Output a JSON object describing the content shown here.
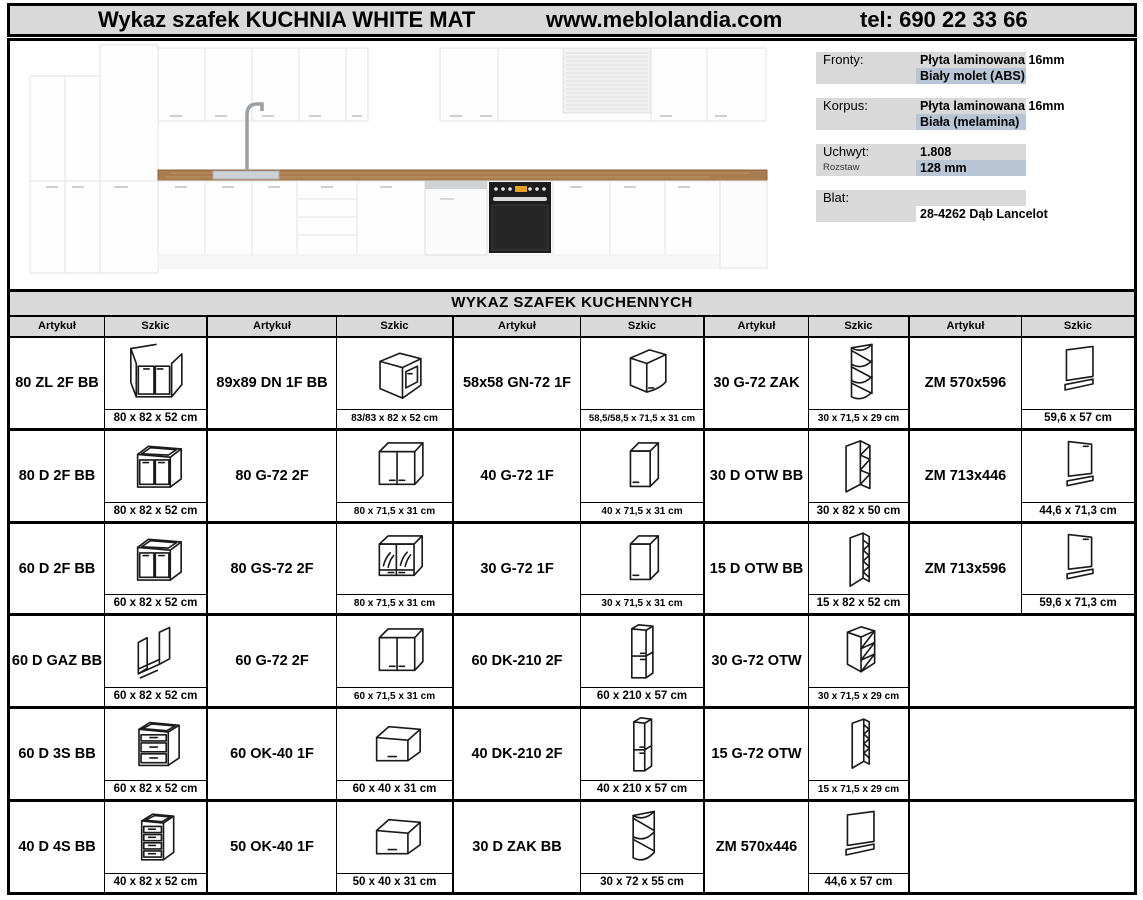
{
  "header": {
    "title": "Wykaz szafek KUCHNIA WHITE MAT",
    "website": "www.meblolandia.com",
    "phone": "tel: 690 22 33 66"
  },
  "colors": {
    "band_gray": "#d9d9d9",
    "highlight_blue": "#b7c5d5",
    "border_black": "#000000",
    "countertop_wood": "#a87c4f",
    "oven_black": "#1c1c1c"
  },
  "kitchen_render": {
    "icon": "kitchen-visualization-image"
  },
  "spec_panel": {
    "rows": [
      {
        "label": "Fronty:",
        "value1": "Płyta laminowana 16mm",
        "value2": "Biały molet (ABS)",
        "value2_highlight": true
      },
      {
        "label": "Korpus:",
        "value1": "Płyta laminowana 16mm",
        "value2": "Biała (melamina)",
        "value2_highlight": true
      },
      {
        "label": "Uchwyt:",
        "sublabel": "Rozstaw",
        "value1": "1.808",
        "value2": "128 mm",
        "value2_highlight": true
      },
      {
        "label": "Blat:",
        "value1": "",
        "value2": "28-4262 Dąb Lancelot",
        "value2_highlight": false
      }
    ]
  },
  "table": {
    "title": "WYKAZ SZAFEK KUCHENNYCH",
    "col_headers": [
      "Artykuł",
      "Szkic"
    ],
    "rows": [
      [
        {
          "code": "80 ZL 2F BB",
          "dims": "80 x 82 x 52 cm",
          "sketch": "sink-base-2door"
        },
        {
          "code": "89x89 DN 1F BB",
          "dims": "83/83 x 82 x 52 cm",
          "sketch": "corner-base-1door"
        },
        {
          "code": "58x58 GN-72 1F",
          "dims": "58,5/58,5 x 71,5 x 31 cm",
          "sketch": "corner-wall-1door"
        },
        {
          "code": "30 G-72 ZAK",
          "dims": "30 x 71,5 x 29 cm",
          "sketch": "corner-open-shelf-3"
        },
        {
          "code": "ZM 570x596",
          "dims": "59,6 x 57 cm",
          "sketch": "cover-panel"
        }
      ],
      [
        {
          "code": "80 D 2F BB",
          "dims": "80 x 82 x 52 cm",
          "sketch": "base-2door"
        },
        {
          "code": "80 G-72 2F",
          "dims": "80 x 71,5 x 31 cm",
          "sketch": "wall-2door"
        },
        {
          "code": "40 G-72 1F",
          "dims": "40 x 71,5 x 31 cm",
          "sketch": "wall-1door"
        },
        {
          "code": "30 D OTW BB",
          "dims": "30 x 82 x 50 cm",
          "sketch": "base-open-shelf-3"
        },
        {
          "code": "ZM 713x446",
          "dims": "44,6 x 71,3 cm",
          "sketch": "appliance-front-panel"
        }
      ],
      [
        {
          "code": "60 D 2F BB",
          "dims": "60 x 82 x 52 cm",
          "sketch": "base-2door"
        },
        {
          "code": "80 GS-72 2F",
          "dims": "80 x 71,5 x 31 cm",
          "sketch": "wall-glass-2door"
        },
        {
          "code": "30 G-72 1F",
          "dims": "30 x 71,5 x 31 cm",
          "sketch": "wall-1door"
        },
        {
          "code": "15 D OTW BB",
          "dims": "15 x 82 x 52 cm",
          "sketch": "cargo-base-15"
        },
        {
          "code": "ZM 713x596",
          "dims": "59,6 x 71,3 cm",
          "sketch": "appliance-front-panel"
        }
      ],
      [
        {
          "code": "60 D GAZ BB",
          "dims": "60 x 82 x 52 cm",
          "sketch": "oven-housing"
        },
        {
          "code": "60 G-72 2F",
          "dims": "60 x 71,5 x 31 cm",
          "sketch": "wall-2door"
        },
        {
          "code": "60 DK-210 2F",
          "dims": "60 x 210 x 57 cm",
          "sketch": "tall-2door"
        },
        {
          "code": "30 G-72 OTW",
          "dims": "30 x 71,5 x 29 cm",
          "sketch": "wall-open-shelf-3"
        },
        null
      ],
      [
        {
          "code": "60 D 3S BB",
          "dims": "60 x 82 x 52 cm",
          "sketch": "drawer-base-3"
        },
        {
          "code": "60 OK-40 1F",
          "dims": "60 x 40 x 31 cm",
          "sketch": "flipup-wall-1door"
        },
        {
          "code": "40 DK-210 2F",
          "dims": "40 x 210 x 57 cm",
          "sketch": "tall-2door-narrow"
        },
        {
          "code": "15 G-72 OTW",
          "dims": "15 x 71,5 x 29 cm",
          "sketch": "cargo-wall-15"
        },
        null
      ],
      [
        {
          "code": "40 D 4S BB",
          "dims": "40 x 82 x 52 cm",
          "sketch": "drawer-base-4"
        },
        {
          "code": "50 OK-40 1F",
          "dims": "50 x 40 x 31 cm",
          "sketch": "flipup-wall-1door"
        },
        {
          "code": "30 D ZAK BB",
          "dims": "30 x 72 x 55 cm",
          "sketch": "corner-open-shelf-2"
        },
        {
          "code": "ZM 570x446",
          "dims": "44,6 x 57 cm",
          "sketch": "cover-panel"
        },
        null
      ]
    ]
  }
}
